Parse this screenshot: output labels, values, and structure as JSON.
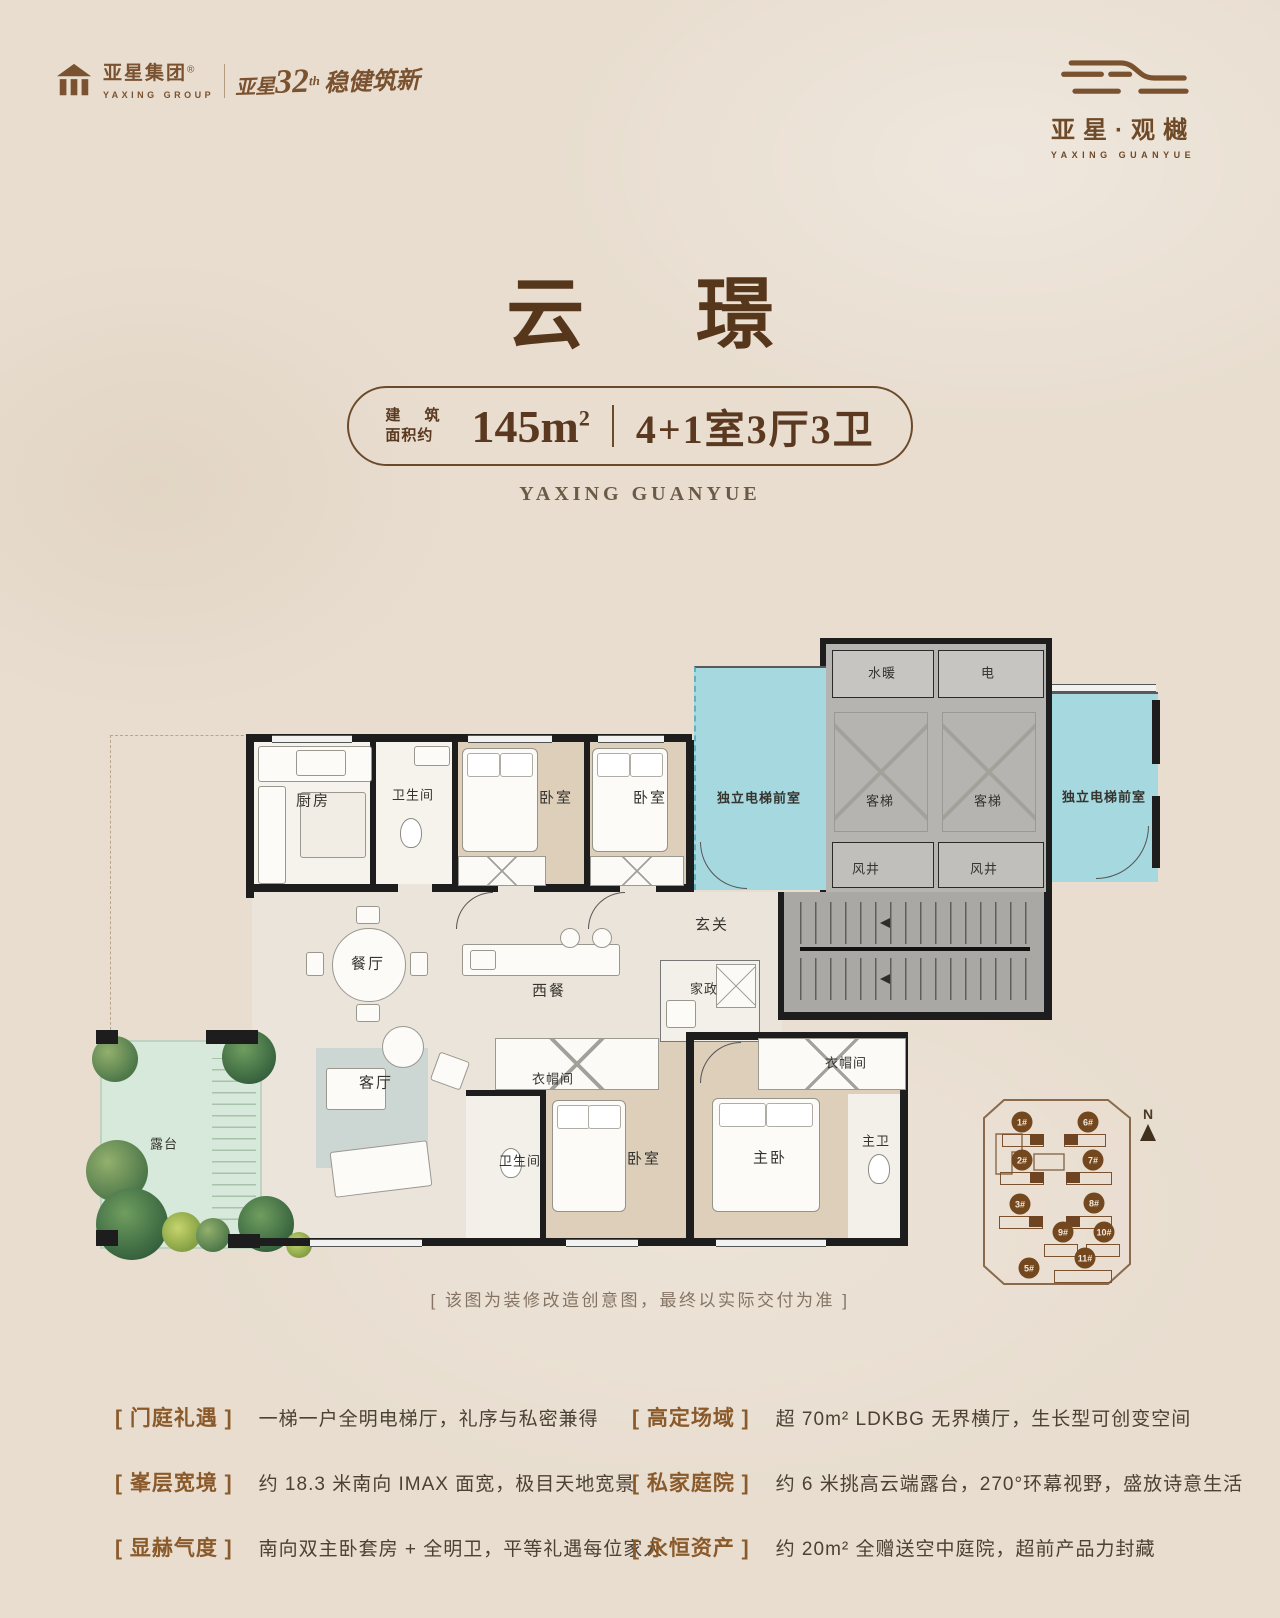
{
  "brand": {
    "group_cn": "亚星集团",
    "reg_mark": "®",
    "group_en": "YAXING GROUP",
    "ann_small": "亚星",
    "ann_num": "32",
    "ann_sup": "th",
    "ann_rest": "稳健筑新",
    "project_cn": "亚星·观樾",
    "project_en": "YAXING GUANYUE"
  },
  "title": {
    "name": "云 璟",
    "area_label_line1": "建 筑",
    "area_label_line2": "面积约",
    "area_value": "145m",
    "area_sup": "2",
    "layout": "4+1室3厅3卫",
    "subtitle_en": "YAXING GUANYUE"
  },
  "plan": {
    "caption": "[ 该图为装修改造创意图，最终以实际交付为准 ]",
    "rooms": [
      {
        "name": "kitchen",
        "label": "厨房"
      },
      {
        "name": "bath-1",
        "label": "卫生间"
      },
      {
        "name": "bedroom-1",
        "label": "卧室"
      },
      {
        "name": "bedroom-2",
        "label": "卧室"
      },
      {
        "name": "lobby-left",
        "label": "独立电梯前室"
      },
      {
        "name": "water-heating",
        "label": "水暖"
      },
      {
        "name": "electrical",
        "label": "电"
      },
      {
        "name": "elevator-1",
        "label": "客梯"
      },
      {
        "name": "elevator-2",
        "label": "客梯"
      },
      {
        "name": "wind-shaft-1",
        "label": "风井"
      },
      {
        "name": "wind-shaft-2",
        "label": "风井"
      },
      {
        "name": "lobby-right",
        "label": "独立电梯前室"
      },
      {
        "name": "foyer",
        "label": "玄关"
      },
      {
        "name": "dining",
        "label": "餐厅"
      },
      {
        "name": "western-dining",
        "label": "西餐"
      },
      {
        "name": "housekeeping",
        "label": "家政"
      },
      {
        "name": "terrace",
        "label": "露台"
      },
      {
        "name": "living",
        "label": "客厅"
      },
      {
        "name": "closet-1",
        "label": "衣帽间"
      },
      {
        "name": "bath-2",
        "label": "卫生间"
      },
      {
        "name": "bedroom-3",
        "label": "卧室"
      },
      {
        "name": "master-bedroom",
        "label": "主卧"
      },
      {
        "name": "master-bath",
        "label": "主卫"
      },
      {
        "name": "closet-2",
        "label": "衣帽间"
      }
    ]
  },
  "site_map": {
    "north": "N",
    "buildings": [
      "1#",
      "6#",
      "2#",
      "7#",
      "3#",
      "8#",
      "9#",
      "10#",
      "11#",
      "5#"
    ]
  },
  "features": [
    {
      "tag": "[ 门庭礼遇 ]",
      "text": "一梯一户全明电梯厅，礼序与私密兼得"
    },
    {
      "tag": "[ 高定场域 ]",
      "text": "超 70m² LDKBG 无界横厅，生长型可创变空间"
    },
    {
      "tag": "[ 峯层宽境 ]",
      "text": "约 18.3 米南向 IMAX 面宽，极目天地宽景"
    },
    {
      "tag": "[ 私家庭院 ]",
      "text": "约 6 米挑高云端露台，270°环幕视野，盛放诗意生活"
    },
    {
      "tag": "[ 显赫气度 ]",
      "text": "南向双主卧套房 + 全明卫，平等礼遇每位家人"
    },
    {
      "tag": "[ 永恒资产 ]",
      "text": "约 20m² 全赠送空中庭院，超前产品力封藏"
    }
  ],
  "colors": {
    "background": "#e8ddcf",
    "brand_brown": "#7a5230",
    "title_brown": "#57371c",
    "lobby_cyan": "#a6d8df",
    "terrace_green": "#d7e9da",
    "wall_black": "#1d1d1d"
  }
}
